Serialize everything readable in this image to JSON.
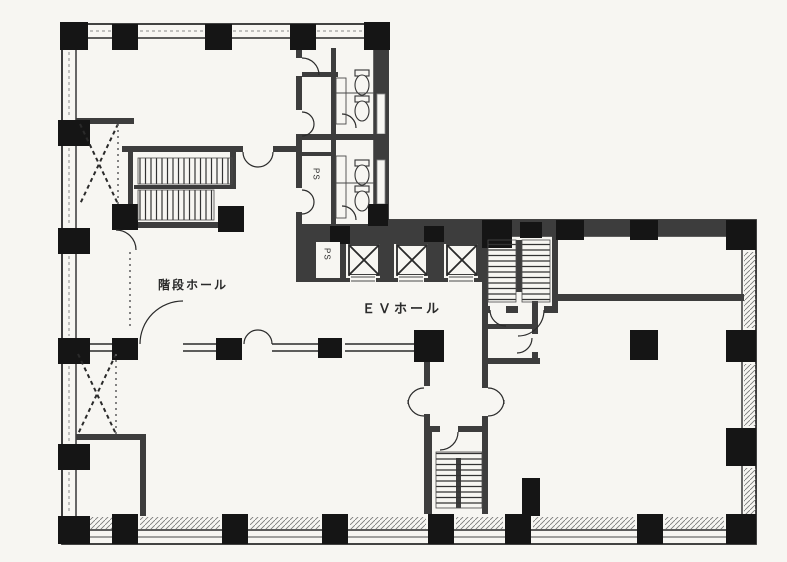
{
  "labels": {
    "stair_hall": "階段ホール",
    "ev_hall": "ＥＶホール",
    "ps_upper": "PS",
    "ps_lower": "PS"
  },
  "colors": {
    "paper": "#f7f6f2",
    "ink": "#2a2a2a",
    "wall": "#3d3d3d",
    "column": "#151515"
  }
}
